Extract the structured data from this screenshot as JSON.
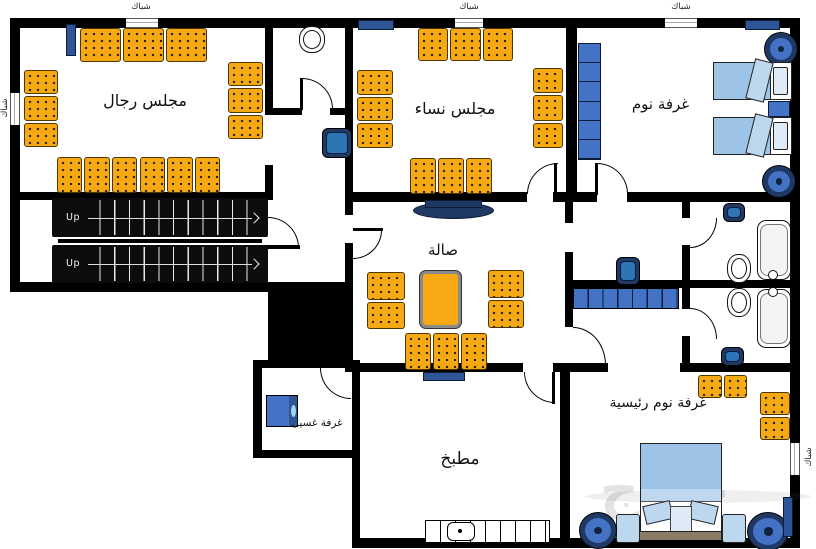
{
  "plan": {
    "rooms": {
      "majlis_rijal": "مجلس رجال",
      "majlis_nisa": "مجلس نساء",
      "bedroom": "غرفة نوم",
      "hall": "صالة",
      "kitchen": "مطبخ",
      "master_bedroom": "غرفة نوم رئيسية",
      "laundry": "غرفة غسيل"
    },
    "window_label": "شباك",
    "stairs_label": "Up",
    "watermark": "حراج",
    "colors": {
      "wall": "#000000",
      "sofa_orange": "#F6A912",
      "furniture_blue": "#4472C4",
      "navy": "#1F3864",
      "bed_blue": "#9DC3E6"
    }
  }
}
